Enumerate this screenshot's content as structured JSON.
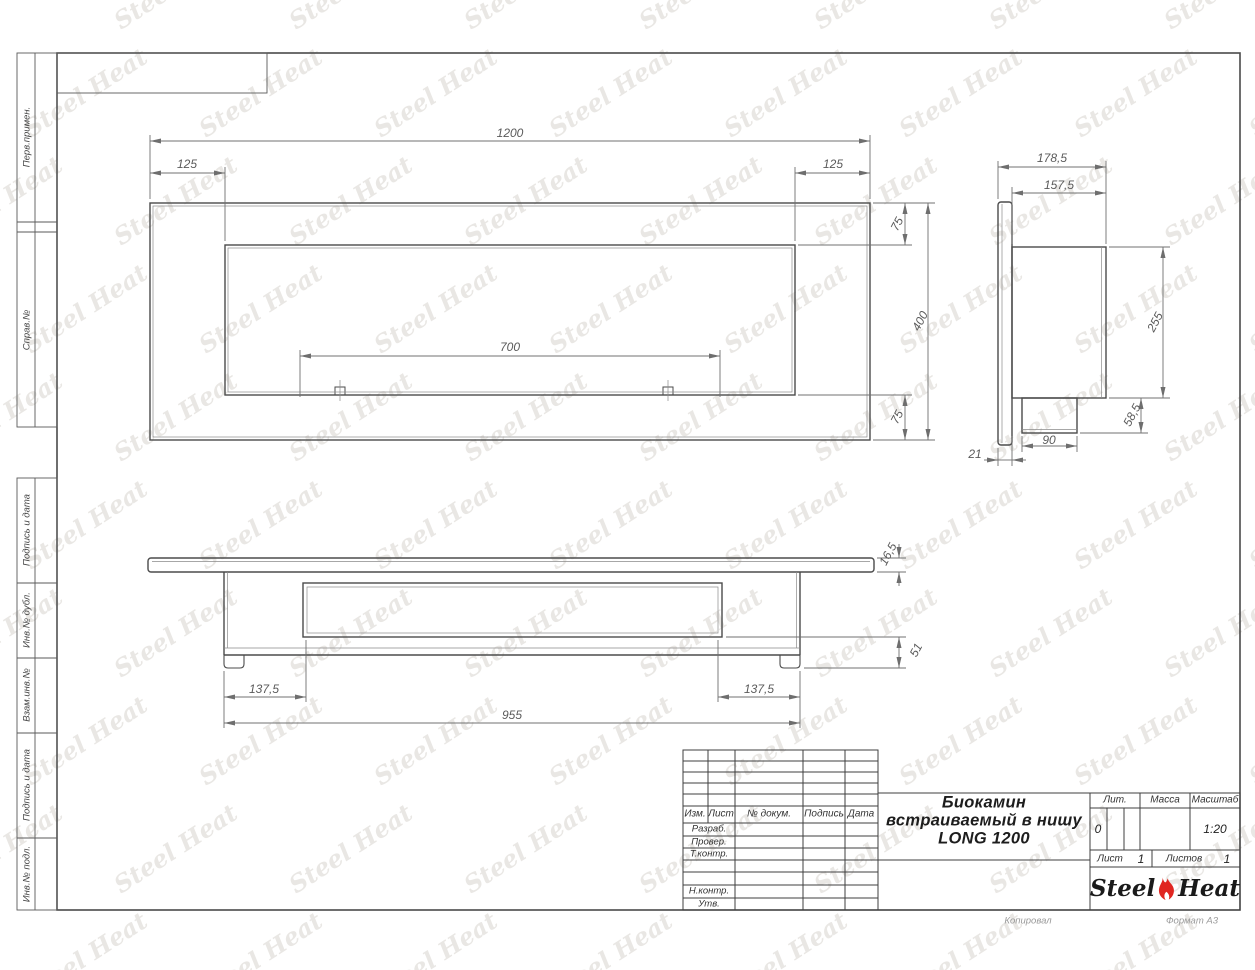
{
  "watermark": {
    "text": "Steel Heat"
  },
  "colors": {
    "line": "#474747",
    "dim_line": "#707070",
    "flame_red": "#e02621",
    "watermark": "#e9e7e4"
  },
  "sidebar": {
    "labels": [
      "Перв.примен.",
      "Справ.№",
      "Подпись и дата",
      "Инв.№ дубл.",
      "Взам.инв.№",
      "Подпись и дата",
      "Инв.№ подл."
    ]
  },
  "views": {
    "front": {
      "dims": {
        "overall_width": "1200",
        "left_offset": "125",
        "right_offset": "125",
        "burner_width": "700",
        "top_margin": "75",
        "overall_height": "400",
        "bottom_margin": "75"
      }
    },
    "side": {
      "dims": {
        "overall_depth": "178,5",
        "body_depth": "157,5",
        "body_height": "255",
        "box_height": "58,5",
        "box_depth": "90",
        "flange_depth": "21"
      }
    },
    "bottom": {
      "dims": {
        "plate_thickness": "16,5",
        "base_height": "51",
        "left_offset": "137,5",
        "body_width": "955",
        "right_offset": "137,5"
      }
    }
  },
  "title_block": {
    "header_cols": [
      "Изм.",
      "Лист",
      "№ докум.",
      "Подпись",
      "Дата"
    ],
    "signature_rows": [
      "Разраб.",
      "Провер.",
      "Т.контр.",
      "Н.контр.",
      "Утв."
    ],
    "title_lines": [
      "Биокамин",
      "встраиваемый в нишу",
      "LONG 1200"
    ],
    "lit_label": "Лит.",
    "lit_value": "0",
    "mass_label": "Масса",
    "scale_label": "Масштаб",
    "scale_value": "1:20",
    "sheet_label": "Лист",
    "sheet_number": "1",
    "sheets_label": "Листов",
    "sheets_total": "1",
    "logo_steel": "Steel",
    "logo_heat": "Heat",
    "footer_copy": "Копировал",
    "footer_format": "Формат A3"
  }
}
